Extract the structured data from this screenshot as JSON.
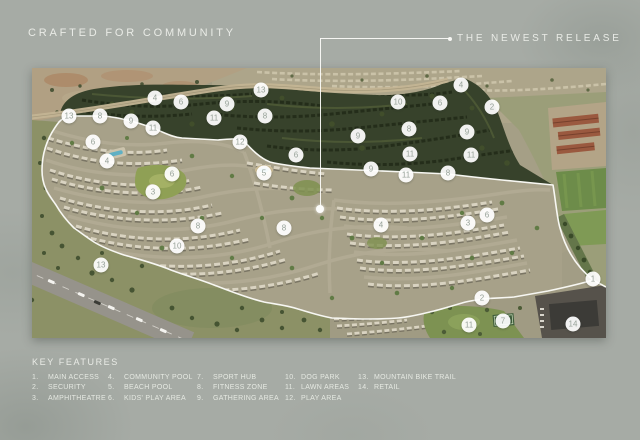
{
  "header": {
    "title": "CRAFTED FOR COMMUNITY",
    "callout_label": "THE NEWEST RELEASE"
  },
  "legend": {
    "title": "KEY FEATURES",
    "columns": [
      [
        {
          "num": "1.",
          "label": "MAIN ACCESS"
        },
        {
          "num": "2.",
          "label": "SECURITY"
        },
        {
          "num": "3.",
          "label": "AMPHITHEATRE"
        }
      ],
      [
        {
          "num": "4.",
          "label": "COMMUNITY POOL"
        },
        {
          "num": "5.",
          "label": "BEACH POOL"
        },
        {
          "num": "6.",
          "label": "KIDS' PLAY AREA"
        }
      ],
      [
        {
          "num": "7.",
          "label": "SPORT HUB"
        },
        {
          "num": "8.",
          "label": "FITNESS ZONE"
        },
        {
          "num": "9.",
          "label": "GATHERING AREA"
        }
      ],
      [
        {
          "num": "10.",
          "label": "DOG PARK"
        },
        {
          "num": "11.",
          "label": "LAWN AREAS"
        },
        {
          "num": "12.",
          "label": "PLAY AREA"
        }
      ],
      [
        {
          "num": "13.",
          "label": "MOUNTAIN BIKE TRAIL"
        },
        {
          "num": "14.",
          "label": "RETAIL"
        }
      ]
    ]
  },
  "map": {
    "markers": [
      {
        "n": "13",
        "x": 37,
        "y": 48
      },
      {
        "n": "8",
        "x": 68,
        "y": 48
      },
      {
        "n": "9",
        "x": 99,
        "y": 53
      },
      {
        "n": "11",
        "x": 121,
        "y": 60
      },
      {
        "n": "6",
        "x": 61,
        "y": 74
      },
      {
        "n": "4",
        "x": 75,
        "y": 93
      },
      {
        "n": "4",
        "x": 123,
        "y": 30
      },
      {
        "n": "6",
        "x": 149,
        "y": 34
      },
      {
        "n": "9",
        "x": 195,
        "y": 36
      },
      {
        "n": "13",
        "x": 229,
        "y": 22
      },
      {
        "n": "11",
        "x": 182,
        "y": 50
      },
      {
        "n": "8",
        "x": 233,
        "y": 48
      },
      {
        "n": "12",
        "x": 208,
        "y": 74
      },
      {
        "n": "6",
        "x": 264,
        "y": 87
      },
      {
        "n": "5",
        "x": 232,
        "y": 105
      },
      {
        "n": "6",
        "x": 140,
        "y": 106
      },
      {
        "n": "3",
        "x": 121,
        "y": 124
      },
      {
        "n": "10",
        "x": 366,
        "y": 34
      },
      {
        "n": "6",
        "x": 408,
        "y": 35
      },
      {
        "n": "2",
        "x": 460,
        "y": 39
      },
      {
        "n": "4",
        "x": 429,
        "y": 17
      },
      {
        "n": "8",
        "x": 377,
        "y": 61
      },
      {
        "n": "9",
        "x": 435,
        "y": 64
      },
      {
        "n": "9",
        "x": 326,
        "y": 68
      },
      {
        "n": "11",
        "x": 378,
        "y": 86
      },
      {
        "n": "11",
        "x": 439,
        "y": 87
      },
      {
        "n": "9",
        "x": 339,
        "y": 101
      },
      {
        "n": "11",
        "x": 374,
        "y": 107
      },
      {
        "n": "8",
        "x": 416,
        "y": 105
      },
      {
        "n": "8",
        "x": 166,
        "y": 158
      },
      {
        "n": "10",
        "x": 145,
        "y": 178
      },
      {
        "n": "8",
        "x": 252,
        "y": 160
      },
      {
        "n": "13",
        "x": 69,
        "y": 197
      },
      {
        "n": "4",
        "x": 349,
        "y": 157
      },
      {
        "n": "3",
        "x": 436,
        "y": 155
      },
      {
        "n": "6",
        "x": 455,
        "y": 147
      },
      {
        "n": "1",
        "x": 561,
        "y": 211
      },
      {
        "n": "2",
        "x": 450,
        "y": 230
      },
      {
        "n": "11",
        "x": 437,
        "y": 257
      },
      {
        "n": "7",
        "x": 471,
        "y": 253
      },
      {
        "n": "14",
        "x": 541,
        "y": 256
      }
    ]
  },
  "colors": {
    "background": "#a6aba5",
    "text": "#e9ebe6",
    "boundary_line": "#f7f7f2",
    "marker_fill": "#ffffff",
    "marker_text": "#96a198",
    "dark_release_zone": "#37422b",
    "built_area": "#a7a189",
    "desert": "#b1a083",
    "lawn": "#8fa055"
  }
}
